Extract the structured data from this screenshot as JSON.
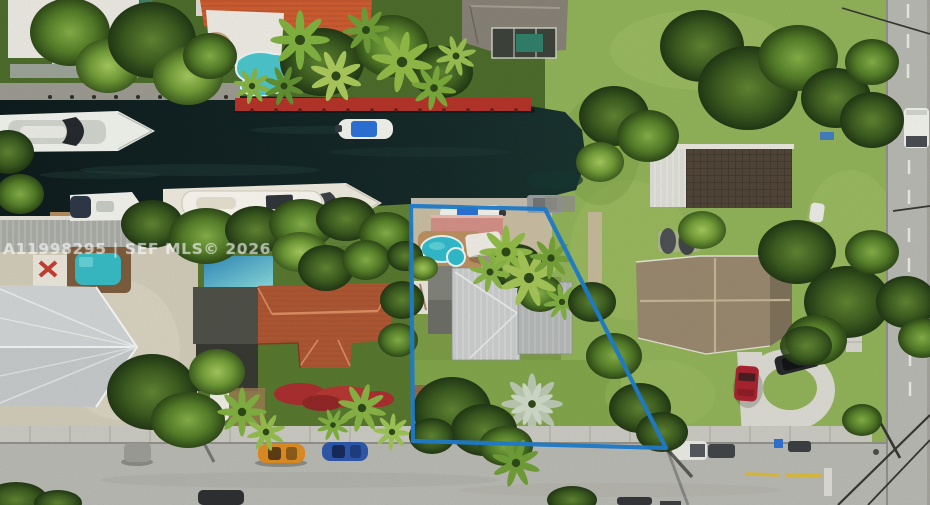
{
  "image": {
    "kind": "aerial drone photo (real-estate listing)",
    "width_px": 930,
    "height_px": 505,
    "scene": "Waterfront residential lot on a canal outlined in blue; docked yachts, neighboring homes with pools, tropical vegetation, street along the bottom and a street on the right edge"
  },
  "watermark": {
    "text": "A11998295 | SEF MLS© 2026",
    "color": "#ffffff",
    "opacity": 0.55
  },
  "boundary": {
    "color": "#1d7bca",
    "stroke_width": "4.2",
    "points": "411,206 545,209 666,448 413,441"
  },
  "palette": {
    "canal_water": "#0e1c1d",
    "vegetation_dark": "#2a4517",
    "vegetation_light": "#8fb057",
    "road": "#b7b7b1",
    "sidewalk": "#c8c8c0",
    "gravel_yard": "#cfc9b6",
    "seawall_red": "#b23126",
    "orange_tile_roof": "#cc5a2e",
    "terracotta_roof": "#ad5531",
    "silver_metal_roof": "#c8cbca",
    "tan_shingle_roof": "#96866c",
    "dark_lattice_roof": "#4f4336",
    "pink_cabana_roof": "#d08d85",
    "pool_teal": "#2fb9c9",
    "boat_white": "#f0f0ea",
    "boat_canopy_blue": "#2a6fd4",
    "tarp_blue": "#3f9fc0",
    "car_red": "#a6212d",
    "car_orange": "#dc8a20",
    "car_blue": "#2b55a8"
  },
  "features": [
    "canal with dark water running horizontally",
    "large white yacht docked on north bank",
    "small boat with blue canopy on north bank",
    "white boat at south-west dock",
    "long cream superyacht along south bank",
    "boat with blue cover at subject dock",
    "blue property boundary outline around subject lot",
    "kidney-shaped teal pool inside boundary",
    "pink flat-roof cabana by subject pool",
    "silver metal roof main house on subject lot",
    "orange-tile-roof home with freeform pool (north shore)",
    "gray hip-roof home with screened pool enclosure (north-east)",
    "west neighbor pool, blue tarp roof and flat gray roofs",
    "terracotta tile roof house (west neighbor)",
    "white ridged metal roof house (far west)",
    "tan cross-gable roof house with circular driveway (east)",
    "red car on driveway",
    "dark SUV on driveway loop",
    "two dark boats stored on lawn",
    "orange car parked on bottom street",
    "blue car parked on bottom street",
    "white pickup truck on bottom street",
    "white box truck on right-side road",
    "yellow lane markings on bottom street",
    "red bougainvillea hedge along street",
    "MLS watermark text"
  ]
}
